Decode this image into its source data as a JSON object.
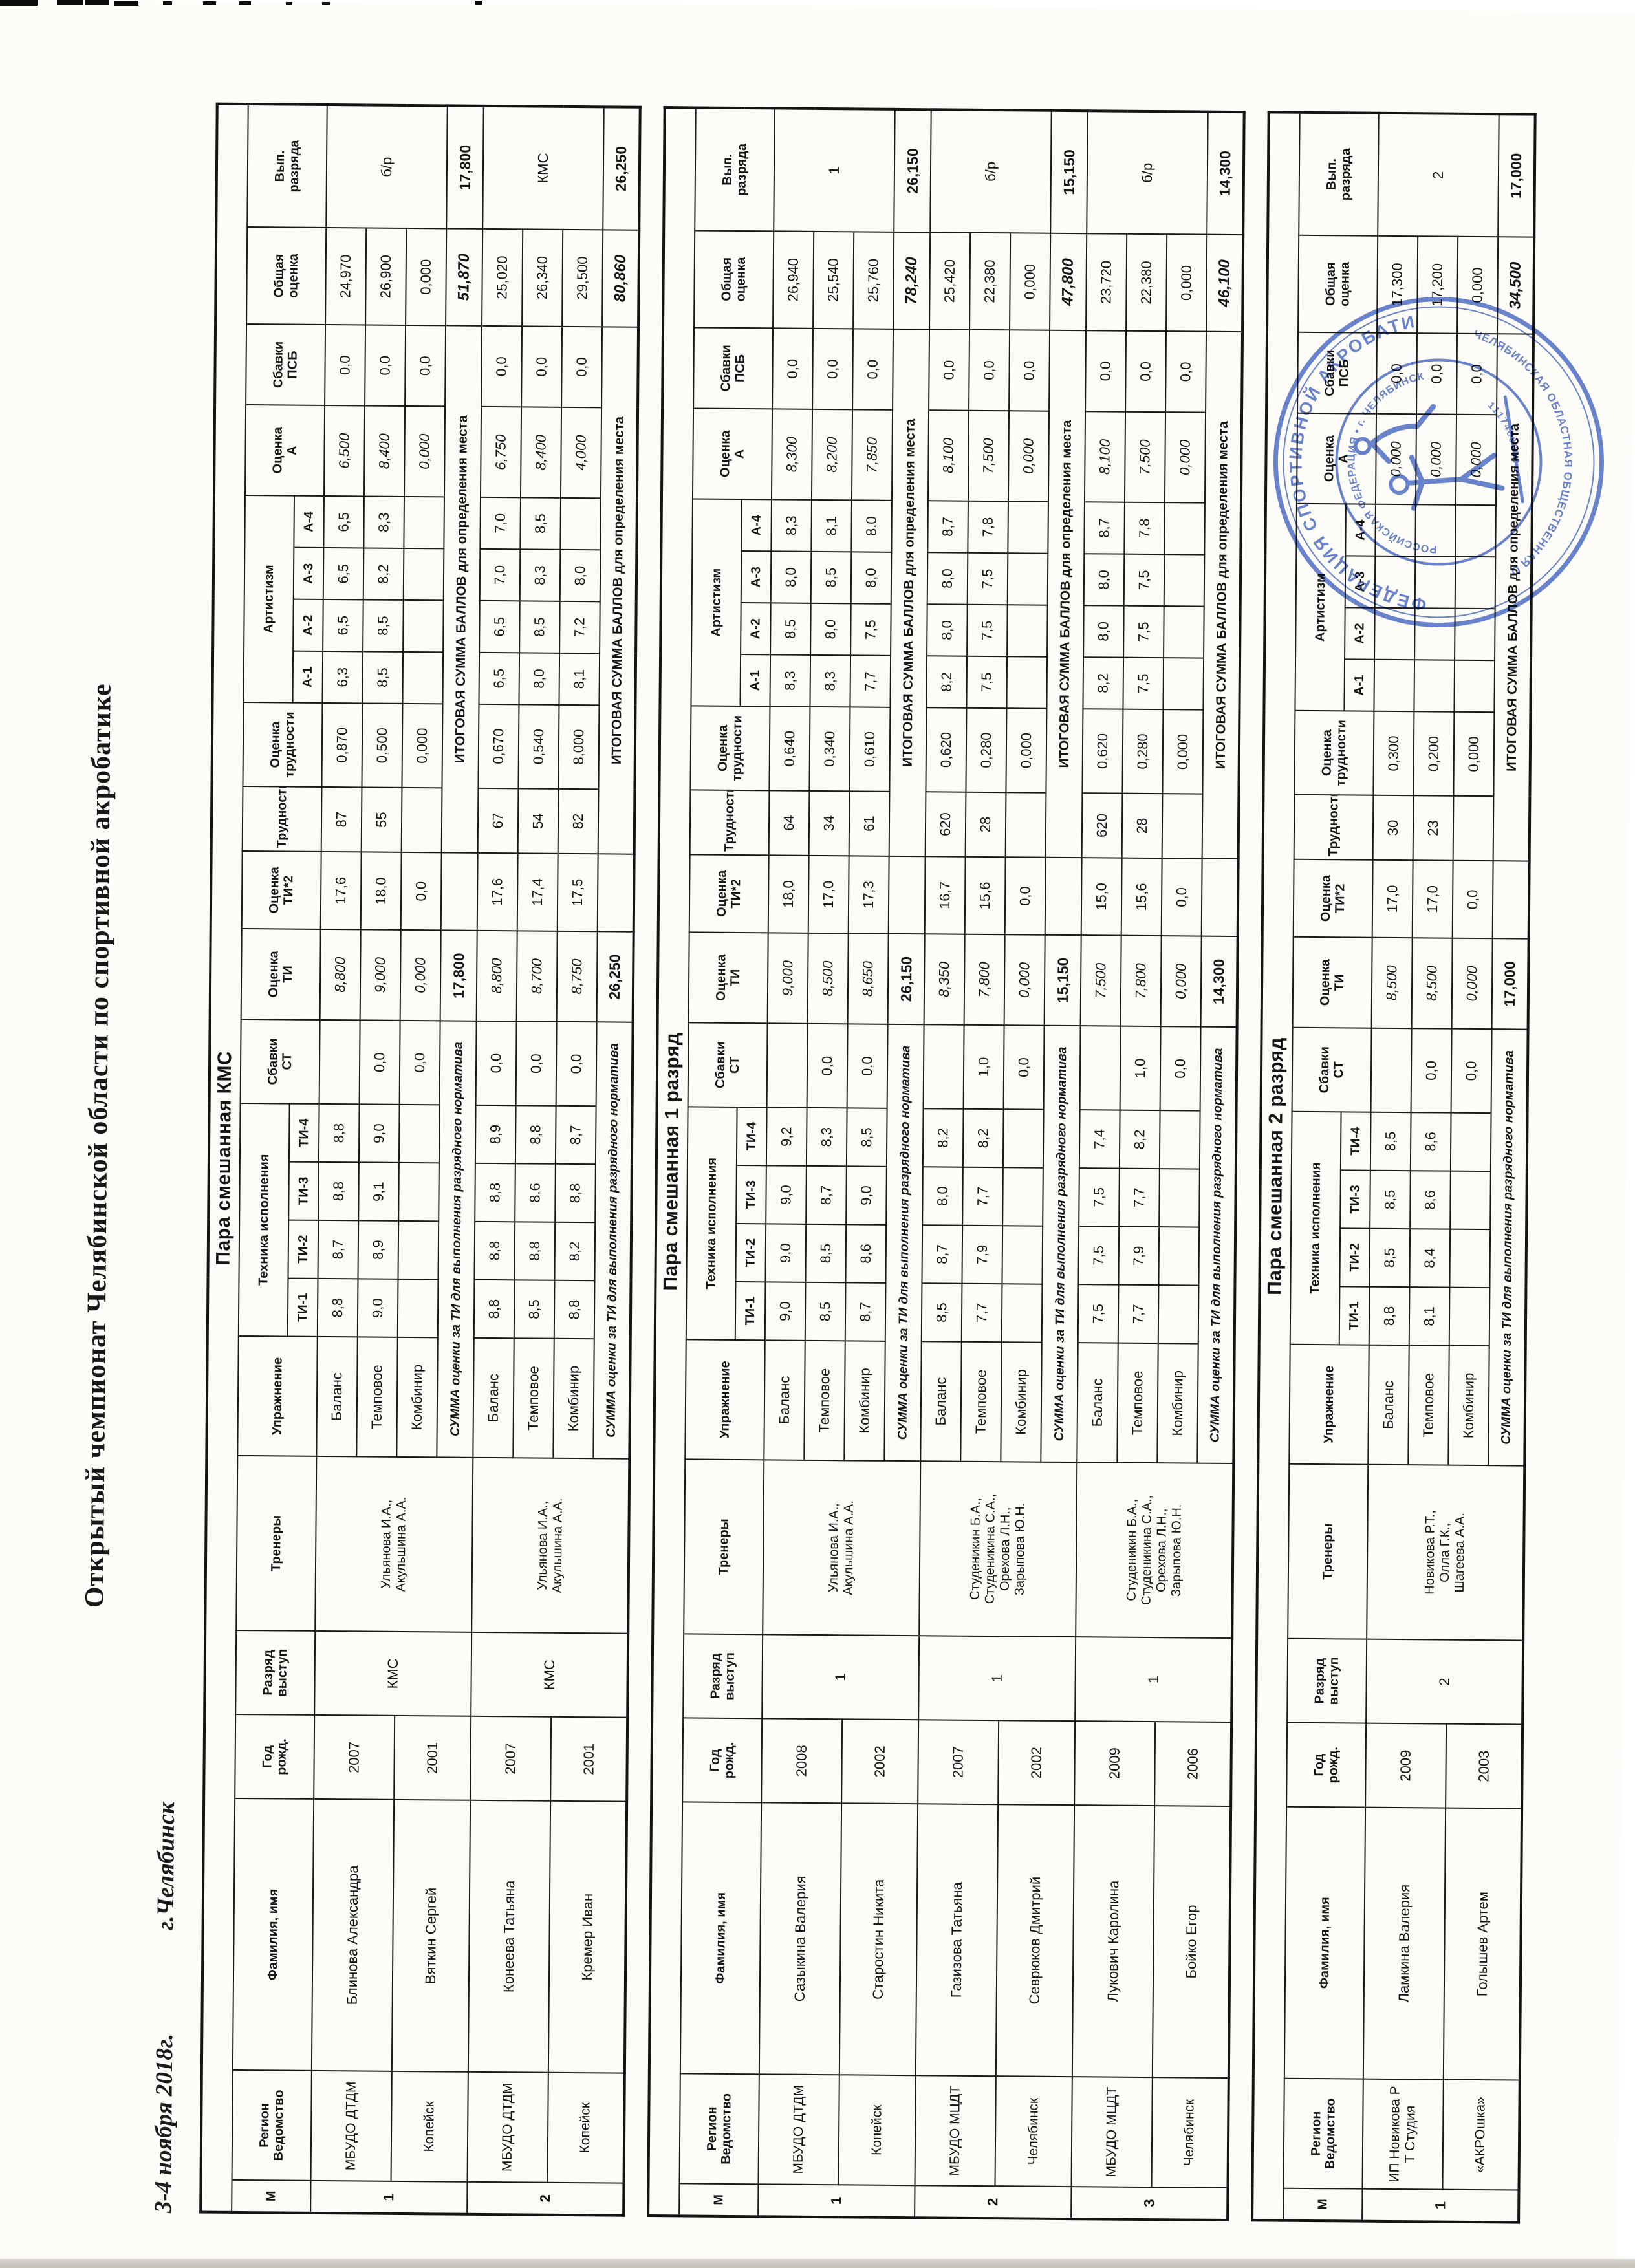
{
  "meta": {
    "title": "Открытый чемпионат  Челябинской области по спортивной акробатике",
    "date": "3-4 ноября  2018г.",
    "city": "г.Челябинск"
  },
  "columns": {
    "num": "М",
    "region": "Регион\nВедомство",
    "name": "Фамилия, имя",
    "year": "Год\nрожд.",
    "grade": "Разряд\nвыступ",
    "trainers": "Тренеры",
    "exercise": "Упражнение",
    "tech": "Техника исполнения",
    "ti": [
      "ТИ-1",
      "ТИ-2",
      "ТИ-3",
      "ТИ-4"
    ],
    "st": "Сбавки\nСТ",
    "oti": "Оценка\nТИ",
    "ti2": "Оценка\nТИ*2",
    "tr": "Трудность",
    "otr": "Оценка\nтрудности",
    "art": "Артистизм",
    "a": [
      "А-1",
      "А-2",
      "А-3",
      "А-4"
    ],
    "oa": "Оценка\nА",
    "psb": "Сбавки\nПСБ",
    "total": "Общая\nоценка",
    "vyp": "Вып.\nразряда"
  },
  "sum_labels": {
    "ti": "СУММА оценки за ТИ для выполнения разрядного норматива",
    "total": "ИТОГОВАЯ СУММА БАЛЛОВ для определения места"
  },
  "stamp": {
    "ring_top": "ФЕДЕРАЦИЯ СПОРТИВНОЙ АКРОБАТИКИ",
    "ring_bottom": "ЧЕЛЯБИНСКАЯ ОБЛАСТНАЯ ОБЩЕСТВЕННАЯ ОРГАНИЗАЦИЯ",
    "inner_top": "РОССИЙСКАЯ ФЕДЕРАЦИЯ • г. ЧЕЛЯБИНСК",
    "number": "1117400000"
  },
  "tables": [
    {
      "title": "Пара смешанная КМС",
      "pairs": [
        {
          "num": "1",
          "dept": "МБУДО ДТДМ",
          "city": "Копейск",
          "a1": {
            "name": "Блинова Александра",
            "year": "2007"
          },
          "a2": {
            "name": "Вяткин Сергей",
            "year": "2001"
          },
          "grade": "КМС",
          "vyp": "б/р",
          "trainers": "Ульянова И.А.,\nАкульшина А.А.",
          "rows": [
            {
              "ex": "Баланс",
              "ti": [
                "8,8",
                "8,7",
                "8,8",
                "8,8"
              ],
              "st": "",
              "oti": "8,800",
              "ti2": "17,6",
              "tr": "87",
              "otr": "0,870",
              "a": [
                "6,3",
                "6,5",
                "6,5",
                "6,5"
              ],
              "oa": "6,500",
              "psb": "0,0",
              "tot": "24,970"
            },
            {
              "ex": "Темповое",
              "ti": [
                "9,0",
                "8,9",
                "9,1",
                "9,0"
              ],
              "st": "0,0",
              "oti": "9,000",
              "ti2": "18,0",
              "tr": "55",
              "otr": "0,500",
              "a": [
                "8,5",
                "8,5",
                "8,2",
                "8,3"
              ],
              "oa": "8,400",
              "psb": "0,0",
              "tot": "26,900"
            },
            {
              "ex": "Комбинир",
              "ti": [
                "",
                "",
                "",
                ""
              ],
              "st": "0,0",
              "oti": "0,000",
              "ti2": "0,0",
              "tr": "",
              "otr": "0,000",
              "a": [
                "",
                "",
                "",
                ""
              ],
              "oa": "0,000",
              "psb": "0,0",
              "tot": "0,000"
            }
          ],
          "sum": {
            "ti": "17,800",
            "total": "51,870",
            "vyp": "17,800"
          }
        },
        {
          "num": "2",
          "dept": "МБУДО ДТДМ",
          "city": "Копейск",
          "a1": {
            "name": "Конеева Татьяна",
            "year": "2007"
          },
          "a2": {
            "name": "Кремер Иван",
            "year": "2001"
          },
          "grade": "КМС",
          "vyp": "КМС",
          "trainers": "Ульянова И.А.,\nАкульшина А.А.",
          "rows": [
            {
              "ex": "Баланс",
              "ti": [
                "8,8",
                "8,8",
                "8,8",
                "8,9"
              ],
              "st": "0,0",
              "oti": "8,800",
              "ti2": "17,6",
              "tr": "67",
              "otr": "0,670",
              "a": [
                "6,5",
                "6,5",
                "7,0",
                "7,0"
              ],
              "oa": "6,750",
              "psb": "0,0",
              "tot": "25,020"
            },
            {
              "ex": "Темповое",
              "ti": [
                "8,5",
                "8,8",
                "8,6",
                "8,8"
              ],
              "st": "0,0",
              "oti": "8,700",
              "ti2": "17,4",
              "tr": "54",
              "otr": "0,540",
              "a": [
                "8,0",
                "8,5",
                "8,3",
                "8,5"
              ],
              "oa": "8,400",
              "psb": "0,0",
              "tot": "26,340"
            },
            {
              "ex": "Комбинир",
              "ti": [
                "8,8",
                "8,2",
                "8,8",
                "8,7"
              ],
              "st": "0,0",
              "oti": "8,750",
              "ti2": "17,5",
              "tr": "82",
              "otr": "8,000",
              "a": [
                "8,1",
                "7,2",
                "8,0",
                ""
              ],
              "oa": "4,000",
              "psb": "0,0",
              "tot": "29,500"
            }
          ],
          "sum": {
            "ti": "26,250",
            "total": "80,860",
            "vyp": "26,250"
          }
        }
      ]
    },
    {
      "title": "Пара смешанная 1 разряд",
      "pairs": [
        {
          "num": "1",
          "dept": "МБУДО ДТДМ",
          "city": "Копейск",
          "a1": {
            "name": "Сазыкина Валерия",
            "year": "2008"
          },
          "a2": {
            "name": "Старостин Никита",
            "year": "2002"
          },
          "grade": "1",
          "vyp": "1",
          "trainers": "Ульянова И.А.,\nАкульшина А.А.",
          "rows": [
            {
              "ex": "Баланс",
              "ti": [
                "9,0",
                "9,0",
                "9,0",
                "9,2"
              ],
              "st": "",
              "oti": "9,000",
              "ti2": "18,0",
              "tr": "64",
              "otr": "0,640",
              "a": [
                "8,3",
                "8,5",
                "8,0",
                "8,3"
              ],
              "oa": "8,300",
              "psb": "0,0",
              "tot": "26,940"
            },
            {
              "ex": "Темповое",
              "ti": [
                "8,5",
                "8,5",
                "8,7",
                "8,3"
              ],
              "st": "0,0",
              "oti": "8,500",
              "ti2": "17,0",
              "tr": "34",
              "otr": "0,340",
              "a": [
                "8,3",
                "8,0",
                "8,5",
                "8,1"
              ],
              "oa": "8,200",
              "psb": "0,0",
              "tot": "25,540"
            },
            {
              "ex": "Комбинир",
              "ti": [
                "8,7",
                "8,6",
                "9,0",
                "8,5"
              ],
              "st": "0,0",
              "oti": "8,650",
              "ti2": "17,3",
              "tr": "61",
              "otr": "0,610",
              "a": [
                "7,7",
                "7,5",
                "8,0",
                "8,0"
              ],
              "oa": "7,850",
              "psb": "0,0",
              "tot": "25,760"
            }
          ],
          "sum": {
            "ti": "26,150",
            "total": "78,240",
            "vyp": "26,150"
          }
        },
        {
          "num": "2",
          "dept": "МБУДО МЦДТ",
          "city": "Челябинск",
          "a1": {
            "name": "Газизова Татьяна",
            "year": "2007"
          },
          "a2": {
            "name": "Севрюков Дмитрий",
            "year": "2002"
          },
          "grade": "1",
          "vyp": "б/р",
          "trainers": "Студеникин Б.А.,\nСтуденикина С.А.,\nОрехова Л.Н.,\nЗарыпова Ю.Н.",
          "rows": [
            {
              "ex": "Баланс",
              "ti": [
                "8,5",
                "8,7",
                "8,0",
                "8,2"
              ],
              "st": "",
              "oti": "8,350",
              "ti2": "16,7",
              "tr": "620",
              "otr": "0,620",
              "a": [
                "8,2",
                "8,0",
                "8,0",
                "8,7"
              ],
              "oa": "8,100",
              "psb": "0,0",
              "tot": "25,420"
            },
            {
              "ex": "Темповое",
              "ti": [
                "7,7",
                "7,9",
                "7,7",
                "8,2"
              ],
              "st": "1,0",
              "oti": "7,800",
              "ti2": "15,6",
              "tr": "28",
              "otr": "0,280",
              "a": [
                "7,5",
                "7,5",
                "7,5",
                "7,8"
              ],
              "oa": "7,500",
              "psb": "0,0",
              "tot": "22,380"
            },
            {
              "ex": "Комбинир",
              "ti": [
                "",
                "",
                "",
                ""
              ],
              "st": "0,0",
              "oti": "0,000",
              "ti2": "0,0",
              "tr": "",
              "otr": "0,000",
              "a": [
                "",
                "",
                "",
                ""
              ],
              "oa": "0,000",
              "psb": "0,0",
              "tot": "0,000"
            }
          ],
          "sum": {
            "ti": "15,150",
            "total": "47,800",
            "vyp": "15,150"
          }
        },
        {
          "num": "3",
          "dept": "МБУДО МЦДТ",
          "city": "Челябинск",
          "a1": {
            "name": "Лукович Каролина",
            "year": "2009"
          },
          "a2": {
            "name": "Бойко Егор",
            "year": "2006"
          },
          "grade": "1",
          "vyp": "б/р",
          "trainers": "Студеникин Б.А.,\nСтуденикина С.А.,\nОрехова Л.Н.,\nЗарыпова Ю.Н.",
          "rows": [
            {
              "ex": "Баланс",
              "ti": [
                "7,5",
                "7,5",
                "7,5",
                "7,4"
              ],
              "st": "",
              "oti": "7,500",
              "ti2": "15,0",
              "tr": "620",
              "otr": "0,620",
              "a": [
                "8,2",
                "8,0",
                "8,0",
                "8,7"
              ],
              "oa": "8,100",
              "psb": "0,0",
              "tot": "23,720"
            },
            {
              "ex": "Темповое",
              "ti": [
                "7,7",
                "7,9",
                "7,7",
                "8,2"
              ],
              "st": "1,0",
              "oti": "7,800",
              "ti2": "15,6",
              "tr": "28",
              "otr": "0,280",
              "a": [
                "7,5",
                "7,5",
                "7,5",
                "7,8"
              ],
              "oa": "7,500",
              "psb": "0,0",
              "tot": "22,380"
            },
            {
              "ex": "Комбинир",
              "ti": [
                "",
                "",
                "",
                ""
              ],
              "st": "0,0",
              "oti": "0,000",
              "ti2": "0,0",
              "tr": "",
              "otr": "0,000",
              "a": [
                "",
                "",
                "",
                ""
              ],
              "oa": "0,000",
              "psb": "0,0",
              "tot": "0,000"
            }
          ],
          "sum": {
            "ti": "14,300",
            "total": "46,100",
            "vyp": "14,300"
          }
        }
      ]
    },
    {
      "title": "Пара смешанная 2 разряд",
      "pairs": [
        {
          "num": "1",
          "dept": "ИП Новикова Р Т Студия",
          "city": "«АКРОшка»",
          "a1": {
            "name": "Ламкина Валерия",
            "year": "2009"
          },
          "a2": {
            "name": "Голышев Артем",
            "year": "2003"
          },
          "grade": "2",
          "vyp": "2",
          "trainers": "Новикова Р.Т.,\nОлла Г.К.,\nШагеева А.А.",
          "rows": [
            {
              "ex": "Баланс",
              "ti": [
                "8,8",
                "8,5",
                "8,5",
                "8,5"
              ],
              "st": "",
              "oti": "8,500",
              "ti2": "17,0",
              "tr": "30",
              "otr": "0,300",
              "a": [
                "",
                "",
                "",
                ""
              ],
              "oa": "0,000",
              "psb": "0,0",
              "tot": "17,300"
            },
            {
              "ex": "Темповое",
              "ti": [
                "8,1",
                "8,4",
                "8,6",
                "8,6"
              ],
              "st": "0,0",
              "oti": "8,500",
              "ti2": "17,0",
              "tr": "23",
              "otr": "0,200",
              "a": [
                "",
                "",
                "",
                ""
              ],
              "oa": "0,000",
              "psb": "0,0",
              "tot": "17,200"
            },
            {
              "ex": "Комбинир",
              "ti": [
                "",
                "",
                "",
                ""
              ],
              "st": "0,0",
              "oti": "0,000",
              "ti2": "0,0",
              "tr": "",
              "otr": "0,000",
              "a": [
                "",
                "",
                "",
                ""
              ],
              "oa": "0,000",
              "psb": "0,0",
              "tot": "0,000"
            }
          ],
          "sum": {
            "ti": "17,000",
            "total": "34,500",
            "vyp": "17,000"
          }
        }
      ]
    }
  ]
}
